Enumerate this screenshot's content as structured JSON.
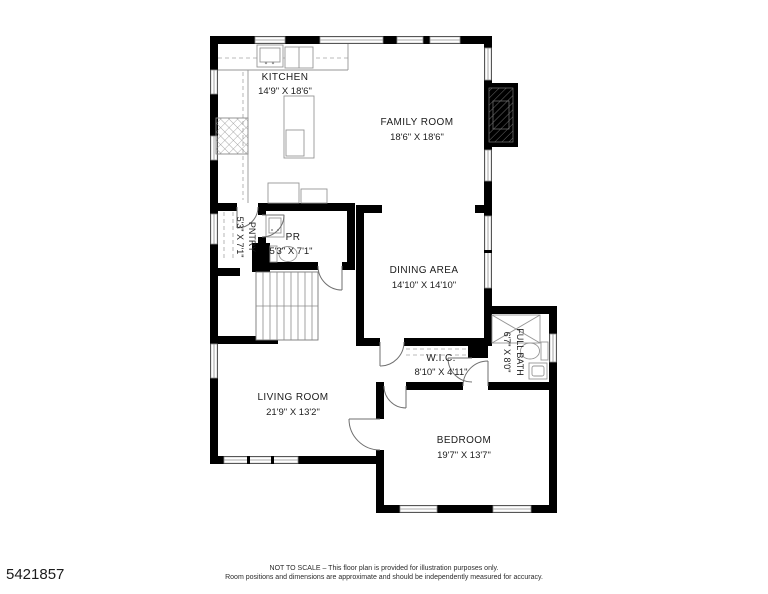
{
  "listing_id": "5421857",
  "disclaimer": {
    "line1": "NOT TO SCALE – This floor plan is provided for illustration purposes only.",
    "line2": "Room positions and dimensions are approximate and should be independently measured for accuracy."
  },
  "rooms": {
    "kitchen": {
      "name": "KITCHEN",
      "dims": "14'9\" X 18'6\""
    },
    "family_room": {
      "name": "FAMILY ROOM",
      "dims": "18'6\" X 18'6\""
    },
    "dining_area": {
      "name": "DINING AREA",
      "dims": "14'10\" X 14'10\""
    },
    "pantry": {
      "name": "PNTRY",
      "dims": "5'3\" X 7'1\""
    },
    "powder_room": {
      "name": "PR",
      "dims": "5'3\" X 7'1\""
    },
    "wic": {
      "name": "W.I.C.",
      "dims": "8'10\" X 4'11\""
    },
    "full_bath": {
      "name": "FULL BATH",
      "dims": "6'7\" X 8'0\""
    },
    "living_room": {
      "name": "LIVING ROOM",
      "dims": "21'9\" X 13'2\""
    },
    "bedroom": {
      "name": "BEDROOM",
      "dims": "19'7\" X 13'7\""
    }
  },
  "colors": {
    "wall": "#000000",
    "background": "#ffffff",
    "fixture": "#8f8f8f",
    "text": "#1c1c1c"
  }
}
